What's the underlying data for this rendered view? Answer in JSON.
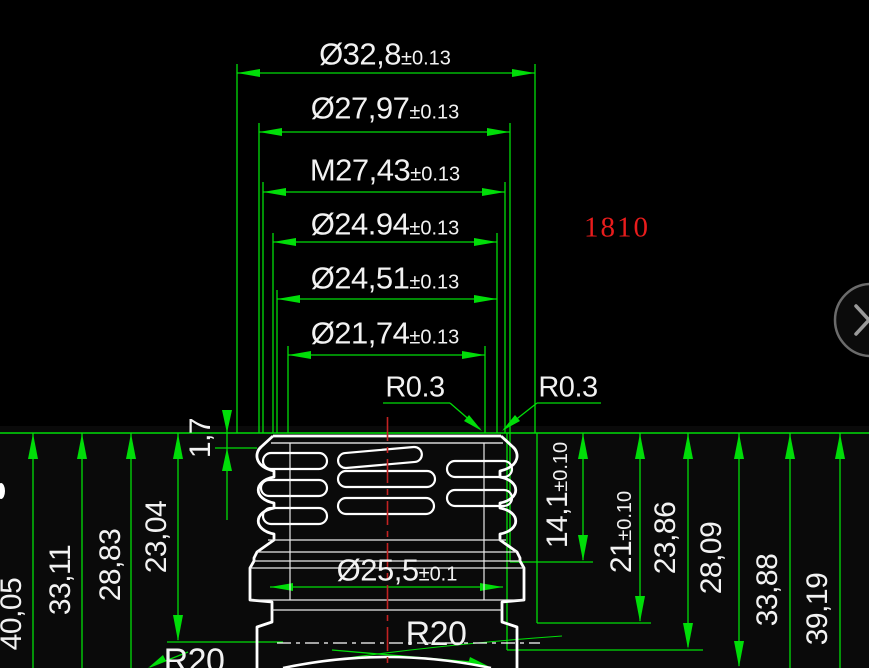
{
  "drawing": {
    "annotation": {
      "part_number": "1810",
      "color": "#e81c1c"
    },
    "top_dims": [
      {
        "label": "Ø32,8",
        "tol": "±0.13"
      },
      {
        "label": "Ø27,97",
        "tol": "±0.13"
      },
      {
        "label": "M27,43",
        "tol": "±0.13"
      },
      {
        "label": "Ø24.94",
        "tol": "±0.13"
      },
      {
        "label": "Ø24,51",
        "tol": "±0.13"
      },
      {
        "label": "Ø21,74",
        "tol": "±0.13"
      }
    ],
    "radius_top": {
      "left": "R0.3",
      "right": "R0.3"
    },
    "neck_dim": {
      "label": "Ø25,5",
      "tol": "±0.1"
    },
    "left_dims": [
      {
        "label": "40,05"
      },
      {
        "label": "33,11"
      },
      {
        "label": "28,83"
      },
      {
        "label": "23,04"
      },
      {
        "label": "1,7"
      }
    ],
    "right_dims": [
      {
        "label": "14,1",
        "tol": "±0.10"
      },
      {
        "label": "21",
        "tol": "±0.10"
      },
      {
        "label": "23,86"
      },
      {
        "label": "28,09"
      },
      {
        "label": "33,88"
      },
      {
        "label": "39,19"
      }
    ],
    "radius_bottom": {
      "left": "R20",
      "center": "R20"
    },
    "colors": {
      "dimension": "#00dd08",
      "geometry": "#ffffff",
      "centerline": "#c22222"
    }
  }
}
